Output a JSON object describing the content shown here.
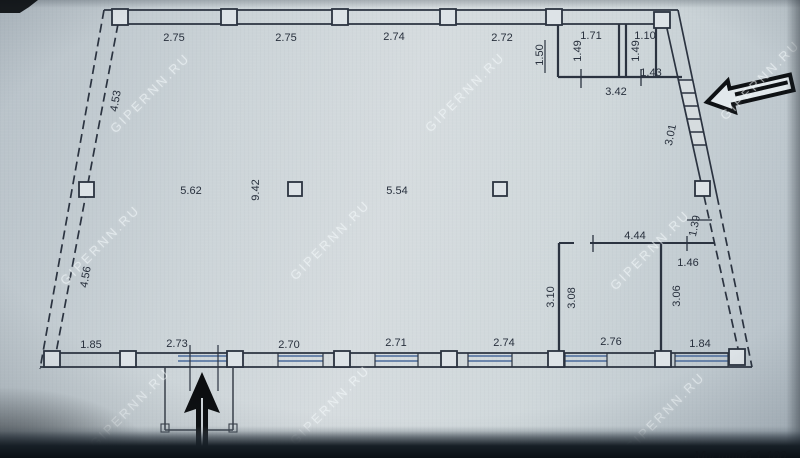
{
  "photo": {
    "watermark": "GIPERNN.RU",
    "scale_note": "Масштаб 1:100"
  },
  "dims": {
    "top1": "2.75",
    "top2": "2.75",
    "top3": "2.74",
    "top4": "2.72",
    "room_a_w": "1.71",
    "room_b_w": "1.10",
    "room_b_inner": "1.43",
    "rooms_total": "3.42",
    "room_left_h": "1.50",
    "room_a_h": "1.49",
    "room_b_h": "1.49",
    "left_upper": "4.53",
    "left_lower": "4.56",
    "hall_w1": "5.62",
    "hall_depth": "9.42",
    "hall_w2": "5.54",
    "right_upper": "3.01",
    "right_mid": "1.39",
    "blk_top": "4.44",
    "blk_top_right": "1.46",
    "blk_left_out": "3.10",
    "blk_left_in": "3.08",
    "blk_right": "3.06",
    "bot1": "1.85",
    "bot2": "2.73",
    "bot3": "2.70",
    "bot4": "2.71",
    "bot5": "2.74",
    "bot6": "2.76",
    "bot7": "1.84"
  }
}
